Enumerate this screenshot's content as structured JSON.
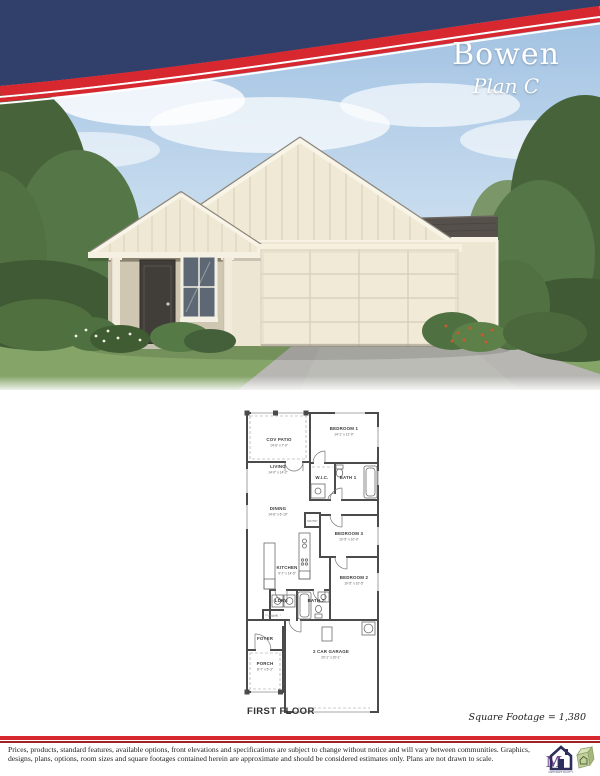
{
  "header": {
    "title": "Bowen",
    "subtitle": "Plan C"
  },
  "colors": {
    "navy": "#31406a",
    "red": "#d7282f",
    "cream": "#ede6d3",
    "roof": "#55504b",
    "sky": "#a9c6e4",
    "grass": "#85a468"
  },
  "floorplan": {
    "first_floor_label": "FIRST FLOOR",
    "square_footage_label": "Square Footage = 1,380",
    "rooms": [
      {
        "name": "COV PATIO",
        "dims": "14'-6\" x 7'-0\"",
        "x": 44,
        "y": 36
      },
      {
        "name": "BEDROOM 1",
        "dims": "14'-1\" x 12'-0\"",
        "x": 109,
        "y": 25
      },
      {
        "name": "LIVING",
        "dims": "14'-0\" x 14'-2\"",
        "x": 43,
        "y": 63
      },
      {
        "name": "W.I.C.",
        "dims": "",
        "x": 87,
        "y": 74
      },
      {
        "name": "BATH 1",
        "dims": "",
        "x": 113,
        "y": 74
      },
      {
        "name": "DINING",
        "dims": "14'-6\" x 6'-10\"",
        "x": 43,
        "y": 105
      },
      {
        "name": "BEDROOM 3",
        "dims": "10'-5\" x 10'-0\"",
        "x": 114,
        "y": 130
      },
      {
        "name": "KITCHEN",
        "dims": "9'-7\" x 14'-5\"",
        "x": 52,
        "y": 164
      },
      {
        "name": "BEDROOM 2",
        "dims": "10'-5\" x 10'-5\"",
        "x": 119,
        "y": 174
      },
      {
        "name": "LDRY",
        "dims": "",
        "x": 46,
        "y": 197
      },
      {
        "name": "BATH 2",
        "dims": "",
        "x": 81,
        "y": 197
      },
      {
        "name": "FOYER",
        "dims": "",
        "x": 30,
        "y": 235
      },
      {
        "name": "PORCH",
        "dims": "8'-7\" x 5'-3\"",
        "x": 30,
        "y": 260
      },
      {
        "name": "2 CAR GARAGE",
        "dims": "20'-1\" x 20'-1\"",
        "x": 96,
        "y": 248
      }
    ],
    "small_labels": [
      {
        "name": "PANTRY",
        "x": 77.5,
        "y": 117
      },
      {
        "name": "COATS",
        "x": 38,
        "y": 212
      }
    ]
  },
  "footer": {
    "disclaimer": "Prices, products, standard features, available options, front elevations and specifications are subject to change without notice and will vary between communities.  Graphics, designs, plans, options, room sizes and square footages contained herein are approximate and should be considered estimates only.  Plans are not drawn to scale.",
    "logo_monogram": "M",
    "logo_caption": "OPPORTUNITY"
  }
}
